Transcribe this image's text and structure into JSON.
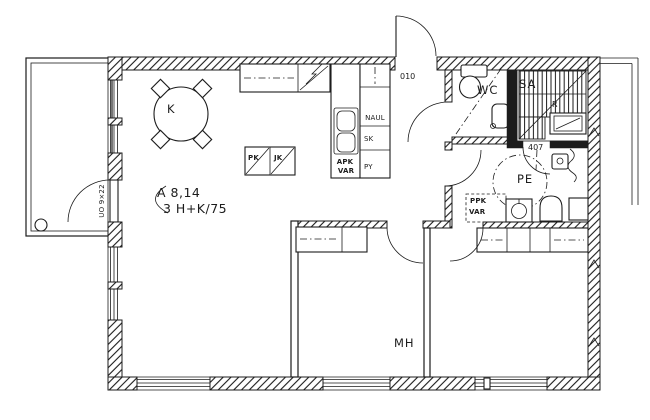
{
  "colors": {
    "ink": "#1c1c1c",
    "paper": "#ffffff"
  },
  "labels": {
    "unit": {
      "line1": "A 8,14",
      "line2": "3 H+K/75"
    },
    "rooms": {
      "kitchen": "K",
      "wc": "WC",
      "sauna": "SA",
      "washroom": "PE",
      "bedroom": "MH"
    },
    "codes": {
      "entry_door": "010",
      "washroom_ref": "407",
      "sauna_mark": "R",
      "balcony_door": "UO 9×22"
    },
    "closets": {
      "coat_rack": "NAUL",
      "cleaning_closet": "SK",
      "laundry": "PY"
    },
    "appliances": {
      "freezer": "PK",
      "fridge": "JK",
      "dishwasher_reservation_line1": "APK",
      "dishwasher_reservation_line2": "VAR",
      "washer_reservation_line1": "PPK",
      "washer_reservation_line2": "VAR"
    }
  }
}
